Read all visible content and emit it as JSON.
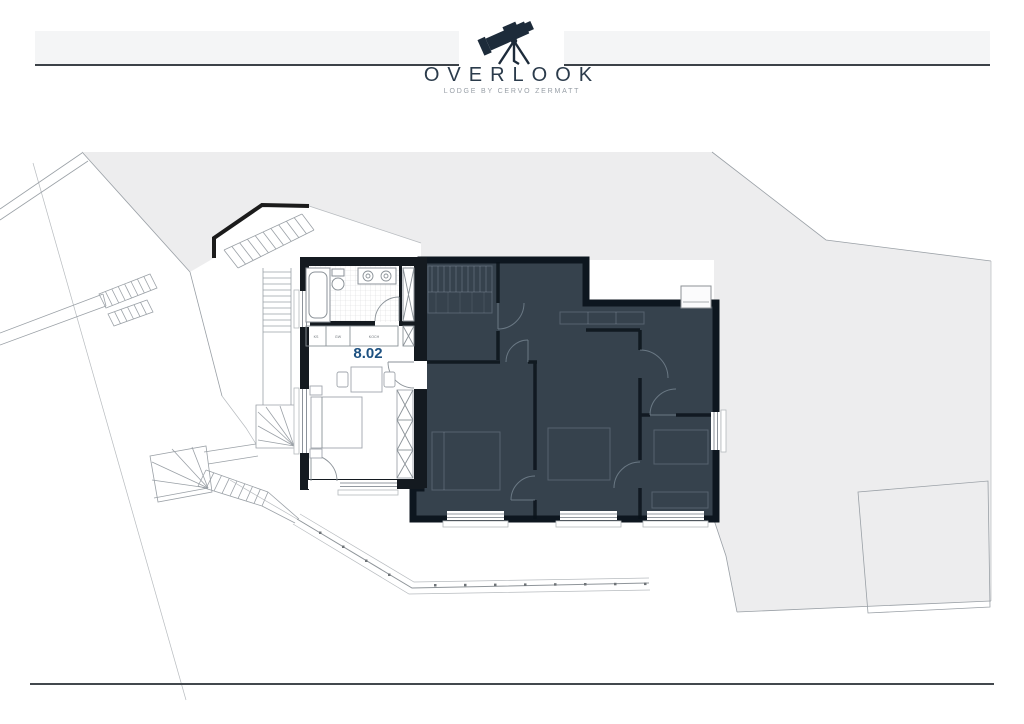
{
  "header": {
    "logo_icon": "telescope-icon",
    "brand": "OVERLOOK",
    "tagline": "LODGE BY CERVO ZERMATT"
  },
  "plan": {
    "unit": {
      "label": "8.02"
    },
    "kitchen_labels": [
      "KS",
      "GW",
      "KOCH"
    ],
    "colors": {
      "terrain": "#ededee",
      "dark_unit_fill": "#36424d",
      "wall": "#141a20",
      "brand_navy": "#1d2b3a",
      "unit_label_blue": "#1d5181"
    }
  }
}
